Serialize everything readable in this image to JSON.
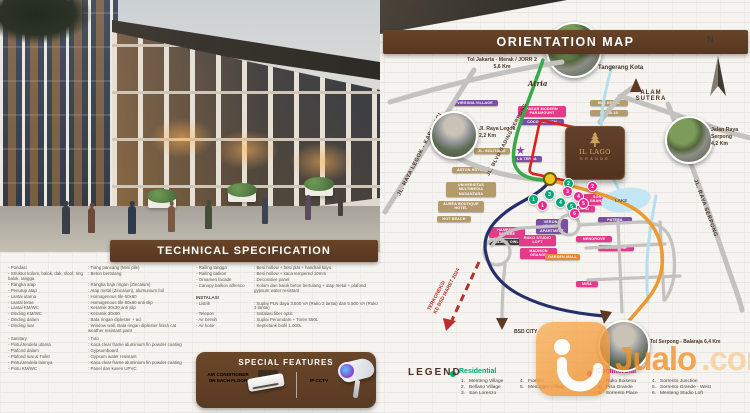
{
  "hero": {
    "description": "3-storey shophouse render with pedestrians"
  },
  "spec": {
    "title": "TECHNICAL SPECIFICATION",
    "left": [
      {
        "label": "Pondasi",
        "value": "Tiang pancang (Mini pile)"
      },
      {
        "label": "Struktur kolom, balok, dak, sloof, ring balok, tangga",
        "value": "Beton bertulang"
      },
      {
        "label": "Rangka atap",
        "value": "Rangka baja ringan (Zincalum)"
      },
      {
        "label": "Penutup atap",
        "value": "Atap metal (Zincalum), alumunium foil"
      },
      {
        "label": "Lantai utama",
        "value": "Homogenous tile 60x60"
      },
      {
        "label": "Lantai teras",
        "value": "Homogenous tile 60x60 anti slip"
      },
      {
        "label": "Lantai KM/WC",
        "value": "Keramik 30x30 anti slip"
      },
      {
        "label": "Dinding KM/WC",
        "value": "Keramik 30x60"
      },
      {
        "label": "Dinding dalam",
        "value": "Bata ringan diplester + aci"
      },
      {
        "label": "Dinding luar",
        "value": "Window wall, Bata ringan diplester finish cat weather resistant paint"
      },
      {
        "label": "Sanitary",
        "value": "Toto"
      },
      {
        "label": "Pintu/Jendela utama",
        "value": "Kaca clear frame aluminium fin powder coating"
      },
      {
        "label": "Plafond dalam",
        "value": "Gypsumboard"
      },
      {
        "label": "Plafond luar & Toilet",
        "value": "Gypsum water resistant"
      },
      {
        "label": "Pintu/Jendela lainnya",
        "value": "Kaca clear frame aluminium fin powder coating"
      },
      {
        "label": "Pintu KM/WC",
        "value": "Panel dan kusen UPVC"
      }
    ],
    "right": [
      {
        "label": "Railing tangga",
        "value": "Besi hollow + besi plat + handrail kayu"
      },
      {
        "label": "Railing balkon",
        "value": "Besi hollow + kaca tempered 10mm"
      },
      {
        "label": "Ornamen facade",
        "value": "Decorative panel"
      },
      {
        "label": "Canopy balkon alfresco",
        "value": "Kolom dan balok beton bertulang + atap metal + plafond gypsum water resistant"
      }
    ],
    "instalasi_header": "INSTALASI",
    "right2": [
      {
        "label": "Listrik",
        "value": "Suplai PLN daya 3.500 VA (Ruko 2 lantai) dan 5.500 VA (Ruko 3 lantai)"
      },
      {
        "label": "Telepon",
        "value": "Instalasi fiber optic"
      },
      {
        "label": "Air bersih",
        "value": "Suplai Perumdam + Toren 550L"
      },
      {
        "label": "Air kotor",
        "value": "Septictank biofil 1.000L"
      }
    ],
    "special": {
      "title": "SPECIAL FEATURES",
      "ac": "AIR CONDITIONER ON EACH FLOOR",
      "cctv": "IP CCTV"
    }
  },
  "map": {
    "title": "ORIENTATION MAP",
    "compass_n": "N",
    "atria": "Atria",
    "tangerang": "Tangerang Kota",
    "alam_sutera_1": "ALAM",
    "alam_sutera_2": "SUTERA",
    "bsd_city": "BSD CITY",
    "lake": "LAKE",
    "toll_jorr_name": "Tol Jakarta - Merak / JORR 2",
    "toll_jorr_dist": "5,6 Km",
    "legok_name": "Jl. Raya Legok",
    "legok_dist": "2,2 Km",
    "serpong_name_1": "Jalan Raya",
    "serpong_name_2": "Serpong",
    "serpong_dist": "4,2 Km",
    "tol_balaraja": "Tol Serpong - Balaraja 6,4 Km",
    "road_legok_karawaci": "JL. RAYA LEGOK - KARAWACI",
    "road_blvd": "JL. BLVD GADING SERPONG",
    "road_serpong": "JL. RAYA SERPONG",
    "note_line1": "TERKONEKSI",
    "note_line2": "KE BSD MARET 2024",
    "project_line1": "IL LAGO",
    "project_line2": "GRANDE",
    "badges": [
      {
        "text": "VIRGINIA VILLAGE"
      },
      {
        "text": "JL. SOLITAIRE"
      },
      {
        "text": "ASTON HOTEL"
      },
      {
        "text": "UNIVERSITAS MULTIMEDIA NUSANTARA"
      },
      {
        "text": "AUREA BOUTIQUE HOTEL"
      },
      {
        "text": "HOT BEACH"
      },
      {
        "text": "PASAR MODERN PARAMOUNT"
      },
      {
        "text": "COCO GARDEN"
      },
      {
        "text": "IBIS HOTEL"
      },
      {
        "text": "MITRA 10"
      },
      {
        "text": "LA TERRA"
      },
      {
        "text": "SORRENTO GRANDE EAST"
      },
      {
        "text": "AVANI"
      },
      {
        "text": "PATERA"
      },
      {
        "text": "MENGROVE"
      },
      {
        "text": "MAGGIORE"
      },
      {
        "text": "VERONA VILLAGE APARTMENT"
      },
      {
        "text": "HAMPTON SQUARE"
      },
      {
        "text": "BLACK OWL"
      },
      {
        "text": "RUKO STUDIO LOFT"
      },
      {
        "text": "MADISON GRANDE"
      },
      {
        "text": "GARDEN MALL"
      },
      {
        "text": "MIRA"
      }
    ],
    "markers": {
      "g": [
        "1",
        "2",
        "3",
        "4",
        "5"
      ],
      "p": [
        "1",
        "2",
        "3",
        "4",
        "5",
        "6"
      ]
    },
    "legend": {
      "title": "LEGEND",
      "residential_label": "Residential",
      "residential": [
        {
          "num": "1.",
          "name": "Menteng Village"
        },
        {
          "num": "2.",
          "name": "Bellano Village"
        },
        {
          "num": "3.",
          "name": "San Lorenzo"
        },
        {
          "num": "4.",
          "name": "Fiordini"
        },
        {
          "num": "5.",
          "name": "Menaggio Village"
        }
      ],
      "commercial_label": "Commercial",
      "commercial": [
        {
          "num": "1.",
          "name": "Ruko Boisena"
        },
        {
          "num": "2.",
          "name": "Pisa Grande"
        },
        {
          "num": "3.",
          "name": "Sorrento Place"
        },
        {
          "num": "4.",
          "name": "Sorrento Junction"
        },
        {
          "num": "5.",
          "name": "Sorrento Grande - West"
        },
        {
          "num": "6.",
          "name": "Menteng Studio Loft"
        }
      ]
    }
  },
  "watermark": {
    "name": "Jualo",
    "tld": ".com"
  },
  "colors": {
    "brown": "#5d3a26",
    "tan_badge": "#b49b6c",
    "purple_badge": "#7b4fa6",
    "pink_badge": "#e5398a",
    "orange_badge": "#e8872e",
    "dark_badge": "#3b3b3b",
    "residential_green": "#00a874",
    "commercial_pink": "#ec268f",
    "road_navy": "#25306b",
    "road_green": "#3aa94c",
    "road_orange": "#eb9a32",
    "note_red": "#b8312f",
    "watermark_orange": "#f49d3f"
  }
}
